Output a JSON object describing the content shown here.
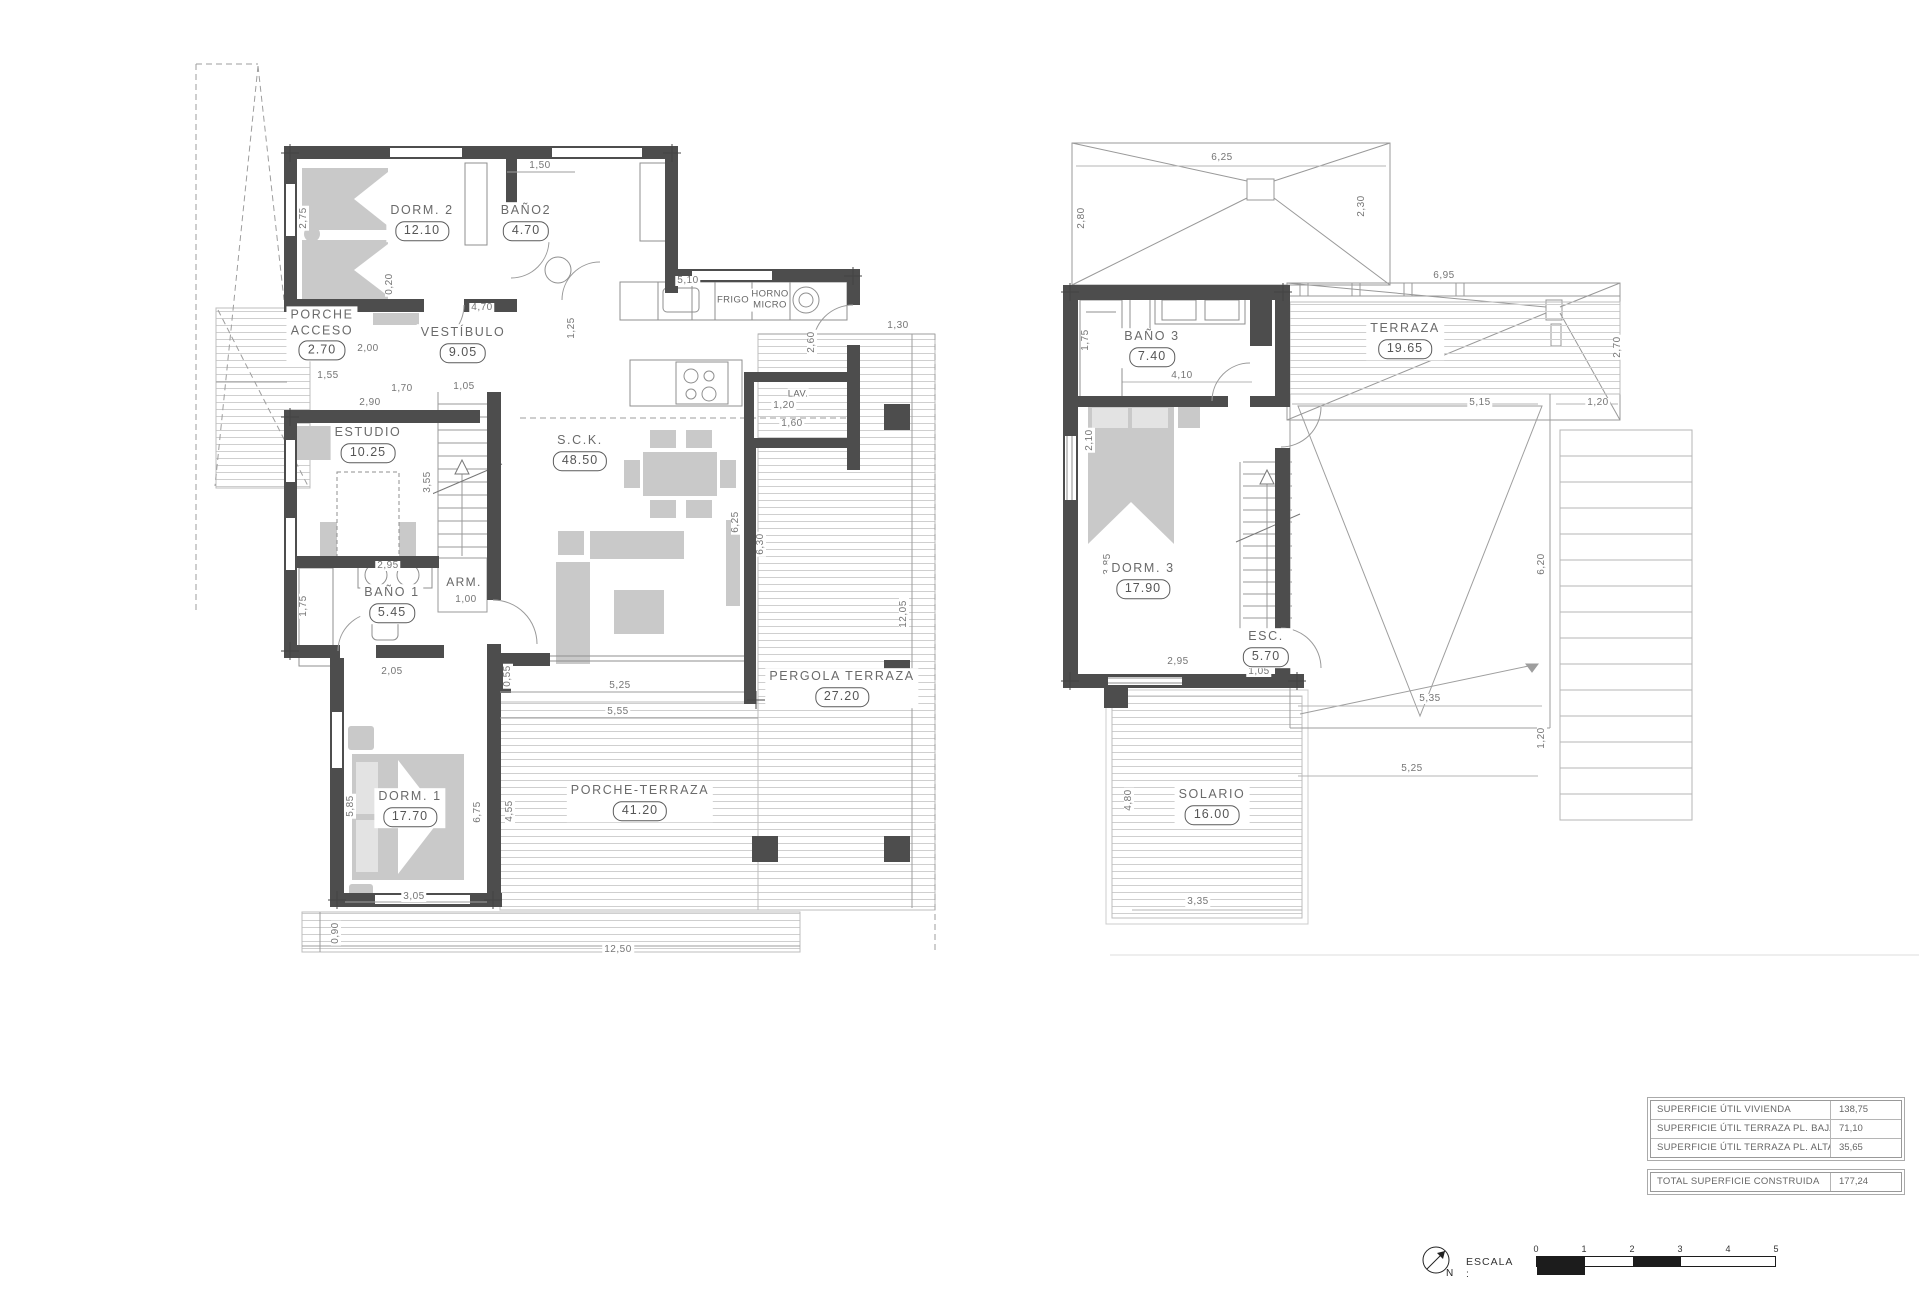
{
  "ground_floor": {
    "rooms": [
      {
        "name": "PORCHE\nACCESO",
        "area": "2.70",
        "x": 322,
        "y": 334
      },
      {
        "name": "DORM. 2",
        "area": "12.10",
        "x": 422,
        "y": 222
      },
      {
        "name": "BAÑO2",
        "area": "4.70",
        "x": 526,
        "y": 222
      },
      {
        "name": "VESTÍBULO",
        "area": "9.05",
        "x": 463,
        "y": 344
      },
      {
        "name": "ESTUDIO",
        "area": "10.25",
        "x": 368,
        "y": 444
      },
      {
        "name": "S.C.K.",
        "area": "48.50",
        "x": 580,
        "y": 452
      },
      {
        "name": "BAÑO 1",
        "area": "5.45",
        "x": 392,
        "y": 604
      },
      {
        "name": "DORM. 1",
        "area": "17.70",
        "x": 410,
        "y": 808
      },
      {
        "name": "PERGOLA TERRAZA",
        "area": "27.20",
        "x": 842,
        "y": 688
      },
      {
        "name": "PORCHE-TERRAZA",
        "area": "41.20",
        "x": 640,
        "y": 802
      }
    ],
    "labels": [
      {
        "t": "FRIGO",
        "x": 733,
        "y": 300
      },
      {
        "t": "HORNO\nMICRO",
        "x": 770,
        "y": 300
      },
      {
        "t": "LAV.",
        "x": 798,
        "y": 394
      },
      {
        "t": "ARM.",
        "x": 464,
        "y": 582,
        "s": 1
      }
    ],
    "dims": [
      {
        "t": "1,50",
        "x": 540,
        "y": 166
      },
      {
        "t": "2,75",
        "x": 304,
        "y": 218,
        "r": 1
      },
      {
        "t": "0,20",
        "x": 390,
        "y": 284,
        "r": 1
      },
      {
        "t": "4,70",
        "x": 482,
        "y": 308
      },
      {
        "t": "5,10",
        "x": 688,
        "y": 281
      },
      {
        "t": "1,25",
        "x": 572,
        "y": 328,
        "r": 1
      },
      {
        "t": "2,60",
        "x": 812,
        "y": 342,
        "r": 1
      },
      {
        "t": "1,55",
        "x": 328,
        "y": 376
      },
      {
        "t": "1,40",
        "x": 352,
        "y": 333,
        "r": 1
      },
      {
        "t": "2,00",
        "x": 368,
        "y": 349
      },
      {
        "t": "1,70",
        "x": 402,
        "y": 389
      },
      {
        "t": "1,05",
        "x": 464,
        "y": 387
      },
      {
        "t": "2,90",
        "x": 370,
        "y": 403
      },
      {
        "t": "3,55",
        "x": 428,
        "y": 482,
        "r": 1
      },
      {
        "t": "2,95",
        "x": 388,
        "y": 566
      },
      {
        "t": "1,75",
        "x": 304,
        "y": 606,
        "r": 1
      },
      {
        "t": "1,00",
        "x": 466,
        "y": 600
      },
      {
        "t": "2,05",
        "x": 392,
        "y": 672
      },
      {
        "t": "1,20",
        "x": 784,
        "y": 406
      },
      {
        "t": "1,60",
        "x": 792,
        "y": 424
      },
      {
        "t": "6,25",
        "x": 736,
        "y": 522,
        "r": 1
      },
      {
        "t": "6,30",
        "x": 761,
        "y": 544,
        "r": 1
      },
      {
        "t": "1,30",
        "x": 898,
        "y": 326
      },
      {
        "t": "12,05",
        "x": 904,
        "y": 614,
        "r": 1
      },
      {
        "t": "0,55",
        "x": 508,
        "y": 676,
        "r": 1
      },
      {
        "t": "5,25",
        "x": 620,
        "y": 686
      },
      {
        "t": "5,55",
        "x": 618,
        "y": 712
      },
      {
        "t": "6,75",
        "x": 478,
        "y": 812,
        "r": 1
      },
      {
        "t": "4,55",
        "x": 510,
        "y": 811,
        "r": 1
      },
      {
        "t": "5,85",
        "x": 351,
        "y": 806,
        "r": 1
      },
      {
        "t": "3,05",
        "x": 414,
        "y": 897
      },
      {
        "t": "0,90",
        "x": 336,
        "y": 933,
        "r": 1
      },
      {
        "t": "12,50",
        "x": 618,
        "y": 950
      }
    ]
  },
  "upper_floor": {
    "rooms": [
      {
        "name": "BAÑO 3",
        "area": "7.40",
        "x": 1152,
        "y": 348
      },
      {
        "name": "TERRAZA",
        "area": "19.65",
        "x": 1405,
        "y": 340
      },
      {
        "name": "DORM. 3",
        "area": "17.90",
        "x": 1143,
        "y": 580
      },
      {
        "name": "ESC.",
        "area": "5.70",
        "x": 1266,
        "y": 648
      },
      {
        "name": "SOLARIO",
        "area": "16.00",
        "x": 1212,
        "y": 806
      }
    ],
    "labels": [],
    "dims": [
      {
        "t": "6,25",
        "x": 1222,
        "y": 158
      },
      {
        "t": "2,80",
        "x": 1082,
        "y": 218,
        "r": 1
      },
      {
        "t": "2,30",
        "x": 1362,
        "y": 206,
        "r": 1
      },
      {
        "t": "6,95",
        "x": 1444,
        "y": 276
      },
      {
        "t": "2,70",
        "x": 1618,
        "y": 347,
        "r": 1
      },
      {
        "t": "1,75",
        "x": 1086,
        "y": 340,
        "r": 1
      },
      {
        "t": "4,10",
        "x": 1182,
        "y": 376
      },
      {
        "t": "2,10",
        "x": 1090,
        "y": 440,
        "r": 1
      },
      {
        "t": "5,15",
        "x": 1480,
        "y": 403
      },
      {
        "t": "1,20",
        "x": 1598,
        "y": 403
      },
      {
        "t": "6,20",
        "x": 1542,
        "y": 564,
        "r": 1
      },
      {
        "t": "3,85",
        "x": 1108,
        "y": 564,
        "r": 1
      },
      {
        "t": "2,95",
        "x": 1178,
        "y": 662
      },
      {
        "t": "1,05",
        "x": 1259,
        "y": 672
      },
      {
        "t": "5,35",
        "x": 1430,
        "y": 699
      },
      {
        "t": "1,20",
        "x": 1542,
        "y": 738,
        "r": 1
      },
      {
        "t": "5,25",
        "x": 1412,
        "y": 769
      },
      {
        "t": "4,80",
        "x": 1129,
        "y": 800,
        "r": 1
      },
      {
        "t": "3,35",
        "x": 1198,
        "y": 902
      }
    ]
  },
  "summary_table": {
    "rows": [
      {
        "label": "SUPERFICIE ÚTIL VIVIENDA",
        "value": "138,75"
      },
      {
        "label": "SUPERFICIE ÚTIL TERRAZA PL. BAJA",
        "value": "71,10"
      },
      {
        "label": "SUPERFICIE ÚTIL TERRAZA PL. ALTA",
        "value": "35,65"
      }
    ],
    "total": {
      "label": "TOTAL SUPERFICIE CONSTRUIDA",
      "value": "177,24"
    }
  },
  "scale_bar": {
    "label": "ESCALA :",
    "north": "N",
    "ticks": [
      "0",
      "1",
      "2",
      "3",
      "4",
      "5"
    ]
  },
  "colors": {
    "wall": "#4d4d4d",
    "furniture": "#c9c9c9",
    "outline": "#8f8f8f",
    "hatch": "#cfcfcf",
    "text": "#666666"
  }
}
